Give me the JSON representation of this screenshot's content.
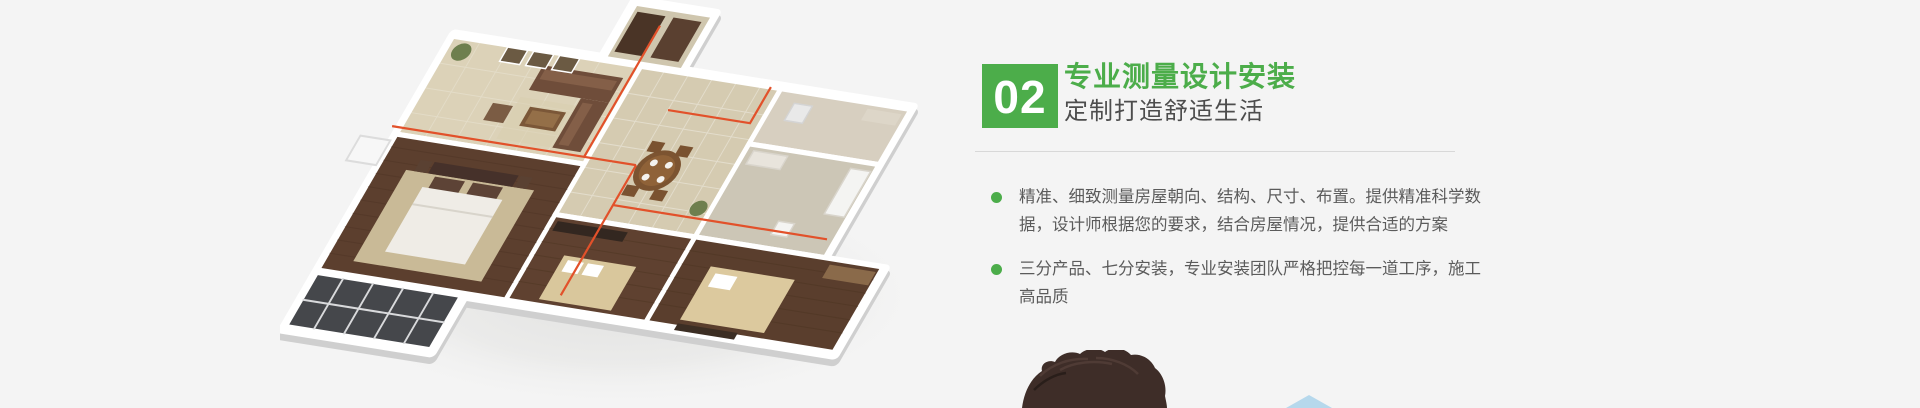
{
  "page": {
    "background_color": "#f4f4f4"
  },
  "section": {
    "step_number": "02",
    "title": "专业测量设计安装",
    "subtitle": "定制打造舒适生活",
    "accent_color": "#4cad4a",
    "text_color": "#5b5b5b",
    "divider_color": "#d8d8d8",
    "bullets": [
      "精准、细致测量房屋朝向、结构、尺寸、布置。提供精准科学数据，设计师根据您的要求，结合房屋情况，提供合适的方案",
      "三分产品、七分安装，专业安装团队严格把控每一道工序，施工高品质"
    ]
  },
  "illustration": {
    "floorplan_icon": "isometric-3d-apartment-floorplan",
    "pipe_color": "#e2512a",
    "wall_color": "#ffffff",
    "wood_floor_color": "#5c3f2e",
    "tile_floor_color": "#d5cbb1"
  },
  "decor": {
    "person_photo_icon": "top-of-head-photo",
    "triangle_color": "#b6d8ec"
  }
}
